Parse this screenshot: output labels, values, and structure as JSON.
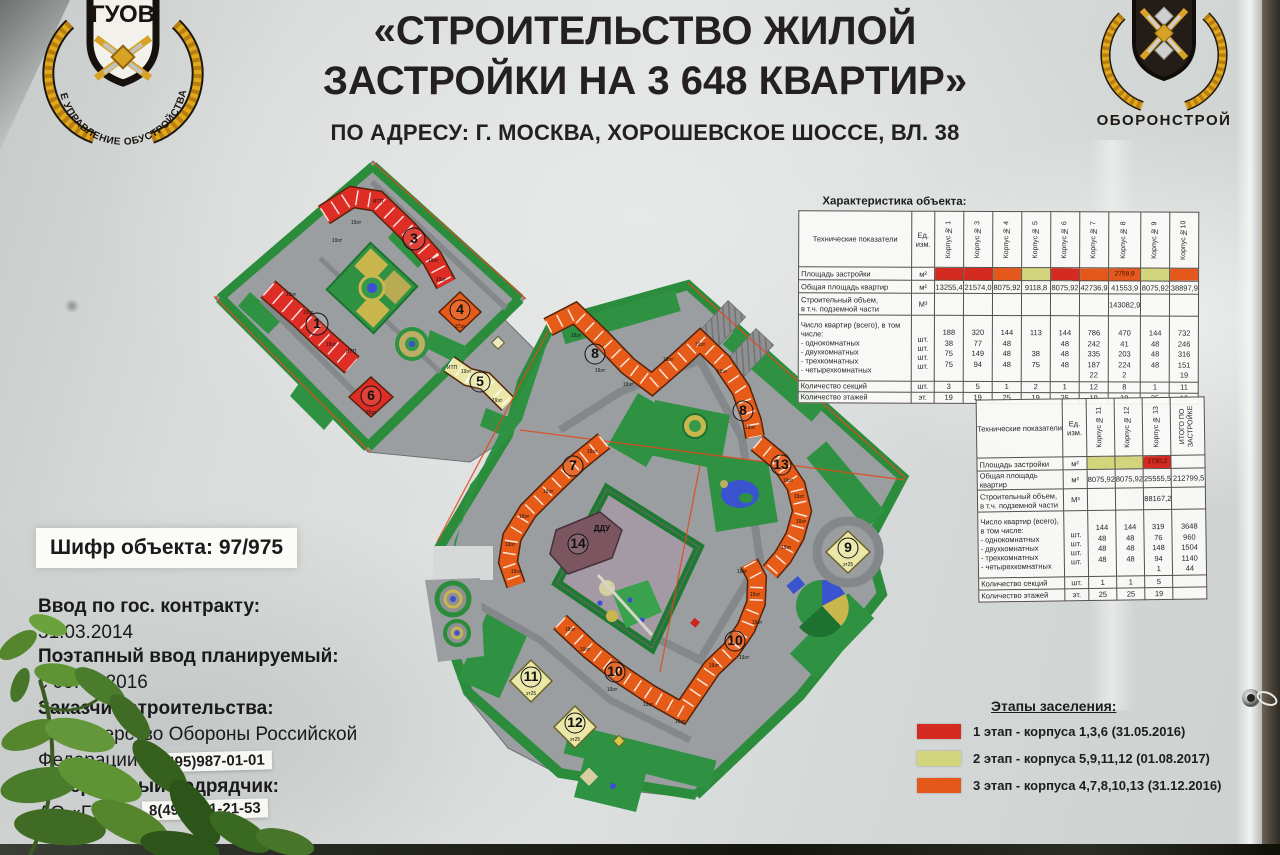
{
  "header": {
    "title_line1": "«СТРОИТЕЛЬСТВО ЖИЛОЙ",
    "title_line2": "ЗАСТРОЙКИ НА 3 648 КВАРТИР»",
    "address": "ПО АДРЕСУ: Г. МОСКВА, ХОРОШЕВСКОЕ ШОССЕ, ВЛ. 38",
    "logo_left": {
      "name": "ГУОВ",
      "ring_text": "ГЛАВНОЕ УПРАВЛЕНИЕ ОБУСТРОЙСТВА ВОЙСК"
    },
    "logo_right": {
      "name": "ОБОРОНСТРОЙ"
    }
  },
  "info": {
    "code_text": "Шифр объекта: 97/975",
    "contract_label": "Ввод по гос. контракту:",
    "contract_date": "31.03.2014",
    "phased_label": "Поэтапный ввод планируемый:",
    "phased_date": "с 09.05.2016",
    "customer_label": "Заказчик строительства:",
    "customer_line1": "Министерство Обороны Российской",
    "customer_line2": "Федерации",
    "customer_phone": "8(495)987-01-01",
    "contractor_label": "Генеральный подрядчик:",
    "contractor_name": "АО «ГУОВ»",
    "contractor_phone": "8(495)781-21-53"
  },
  "stage_colors": {
    "red": "#d42a1f",
    "yellow": "#d2d57b",
    "orange": "#e4581c",
    "none": ""
  },
  "tables": [
    {
      "caption": "Характеристика объекта:",
      "head_label": "Технические показатели",
      "head_unit": "Ед.\nизм.",
      "cols": [
        "Корпус № 1",
        "Корпус № 3",
        "Корпус № 4",
        "Корпус № 5",
        "Корпус № 6",
        "Корпус № 7",
        "Корпус № 8",
        "Корпус № 9",
        "Корпус №10"
      ],
      "rows": [
        {
          "type": "stage",
          "label": "Площадь застройки",
          "unit": "м²",
          "cells": [
            {
              "s": "red"
            },
            {
              "s": "red"
            },
            {
              "s": "orange"
            },
            {
              "s": "yellow"
            },
            {
              "s": "red"
            },
            {
              "s": "orange"
            },
            {
              "s": "orange",
              "v": "2759,9"
            },
            {
              "s": "yellow"
            },
            {
              "s": "orange"
            }
          ]
        },
        {
          "type": "plain",
          "label": "Общая площадь квартир",
          "unit": "м²",
          "cells": [
            "13255,4",
            "21574,0",
            "8075,92",
            "9118,8",
            "8075,92",
            "42736,9",
            "41553,9",
            "8075,92",
            "38897,9"
          ]
        },
        {
          "type": "plain",
          "label": "Строительный объем,\nв т.ч. подземной части",
          "unit": "М³",
          "cells": [
            "",
            "",
            "",
            "",
            "",
            "",
            "143082,9",
            "",
            ""
          ]
        },
        {
          "type": "multi",
          "label": "Число квартир (всего), в том числе:\n- однокомнатных\n- двухкомнатных\n- трехкомнатных\n- четырехкомнатных",
          "unit": "\nшт.\nшт.\nшт.\nшт.",
          "cells": [
            [
              "188",
              "38",
              "75",
              "75",
              ""
            ],
            [
              "320",
              "77",
              "149",
              "94",
              ""
            ],
            [
              "144",
              "48",
              "48",
              "48",
              ""
            ],
            [
              "113",
              "",
              "38",
              "75",
              ""
            ],
            [
              "144",
              "48",
              "48",
              "48",
              ""
            ],
            [
              "786",
              "242",
              "335",
              "187",
              "22"
            ],
            [
              "470",
              "41",
              "203",
              "224",
              "2"
            ],
            [
              "144",
              "48",
              "48",
              "48",
              ""
            ],
            [
              "732",
              "246",
              "316",
              "151",
              "19"
            ]
          ]
        },
        {
          "type": "plain",
          "label": "Количество секций",
          "unit": "шт.",
          "cells": [
            "3",
            "5",
            "1",
            "2",
            "1",
            "12",
            "8",
            "1",
            "11"
          ]
        },
        {
          "type": "plain",
          "label": "Количество этажей",
          "unit": "эт.",
          "cells": [
            "19",
            "19",
            "25",
            "19",
            "25",
            "19",
            "19",
            "25",
            "19"
          ]
        }
      ]
    },
    {
      "caption": "",
      "head_label": "Технические показатели",
      "head_unit": "Ед. изм.",
      "cols": [
        "Корпус № 11",
        "Корпус № 12",
        "Корпус № 13",
        "ИТОГО ПО\nЗАСТРОЙКЕ"
      ],
      "rows": [
        {
          "type": "stage",
          "label": "Площадь застройки",
          "unit": "м²",
          "cells": [
            {
              "s": "yellow"
            },
            {
              "s": "yellow"
            },
            {
              "s": "red",
              "v": "1730,2"
            },
            {
              "s": "none"
            }
          ]
        },
        {
          "type": "plain",
          "label": "Общая площадь квартир",
          "unit": "м²",
          "cells": [
            "8075,92",
            "8075,92",
            "25555,5",
            "212799,5"
          ]
        },
        {
          "type": "plain",
          "label": "Строительный объем,\nв т.ч. подземной части",
          "unit": "М³",
          "cells": [
            "",
            "",
            "88167,2",
            ""
          ]
        },
        {
          "type": "multi",
          "label": "Число квартир (всего), в том числе:\n- однокомнатных\n- двухкомнатных\n- трехкомнатных\n- четырехкомнатных",
          "unit": "\nшт.\nшт.\nшт.\nшт.",
          "cells": [
            [
              "144",
              "48",
              "48",
              "48",
              ""
            ],
            [
              "144",
              "48",
              "48",
              "48",
              ""
            ],
            [
              "319",
              "76",
              "148",
              "94",
              "1"
            ],
            [
              "3648",
              "960",
              "1504",
              "1140",
              "44"
            ]
          ]
        },
        {
          "type": "plain",
          "label": "Количество секций",
          "unit": "шт.",
          "cells": [
            "1",
            "1",
            "5",
            ""
          ]
        },
        {
          "type": "plain",
          "label": "Количество этажей",
          "unit": "эт.",
          "cells": [
            "25",
            "25",
            "19",
            ""
          ]
        }
      ]
    }
  ],
  "legend": {
    "title": "Этапы заселения:",
    "items": [
      {
        "stage": "red",
        "text": "1 этап -  корпуса 1,3,6 (31.05.2016)"
      },
      {
        "stage": "yellow",
        "text": "2 этап  - корпуса 5,9,11,12 (01.08.2017)"
      },
      {
        "stage": "orange",
        "text": "3 этап -  корпуса 4,7,8,10,13 (31.12.2016)"
      }
    ]
  },
  "map": {
    "labels": [
      {
        "t": "3",
        "x": 414,
        "y": 243,
        "r": 11
      },
      {
        "t": "1",
        "x": 317,
        "y": 328,
        "r": 11
      },
      {
        "t": "4",
        "x": 460,
        "y": 314,
        "r": 10
      },
      {
        "t": "5",
        "x": 480,
        "y": 386,
        "r": 10
      },
      {
        "t": "6",
        "x": 371,
        "y": 400,
        "r": 10
      },
      {
        "t": "7",
        "x": 573,
        "y": 470,
        "r": 10
      },
      {
        "t": "8",
        "x": 595,
        "y": 358,
        "r": 10
      },
      {
        "t": "8",
        "x": 743,
        "y": 415,
        "r": 10
      },
      {
        "t": "9",
        "x": 848,
        "y": 552,
        "r": 10
      },
      {
        "t": "10",
        "x": 615,
        "y": 676,
        "r": 10
      },
      {
        "t": "10",
        "x": 735,
        "y": 645,
        "r": 10
      },
      {
        "t": "11",
        "x": 531,
        "y": 681,
        "r": 10
      },
      {
        "t": "12",
        "x": 575,
        "y": 727,
        "r": 10
      },
      {
        "t": "13",
        "x": 781,
        "y": 469,
        "r": 10
      },
      {
        "t": "14",
        "x": 578,
        "y": 548,
        "r": 10
      },
      {
        "t": "ДДУ",
        "x": 602,
        "y": 531,
        "s": 8,
        "b": 1
      },
      {
        "t": "27эт",
        "x": 460,
        "y": 328,
        "s": 5
      },
      {
        "t": "25эт",
        "x": 371,
        "y": 414,
        "s": 5
      },
      {
        "t": "эт25",
        "x": 848,
        "y": 566,
        "s": 5
      },
      {
        "t": "эт25",
        "x": 531,
        "y": 695,
        "s": 5
      },
      {
        "t": "эт25",
        "x": 575,
        "y": 741,
        "s": 5
      },
      {
        "t": "ИТП",
        "x": 378,
        "y": 203,
        "s": 5
      },
      {
        "t": "ИТП",
        "x": 351,
        "y": 353,
        "s": 5
      },
      {
        "t": "ИТП",
        "x": 452,
        "y": 369,
        "s": 5
      },
      {
        "t": "19эт",
        "x": 356,
        "y": 224,
        "s": 5
      },
      {
        "t": "19эт",
        "x": 337,
        "y": 242,
        "s": 5
      },
      {
        "t": "19эт",
        "x": 433,
        "y": 262,
        "s": 5
      },
      {
        "t": "19эт",
        "x": 441,
        "y": 281,
        "s": 5
      },
      {
        "t": "19эт",
        "x": 291,
        "y": 296,
        "s": 5
      },
      {
        "t": "19эт",
        "x": 308,
        "y": 314,
        "s": 5
      },
      {
        "t": "19эт",
        "x": 331,
        "y": 346,
        "s": 5
      },
      {
        "t": "19эт",
        "x": 466,
        "y": 373,
        "s": 5
      },
      {
        "t": "19эт",
        "x": 497,
        "y": 402,
        "s": 5
      },
      {
        "t": "19эт",
        "x": 576,
        "y": 337,
        "s": 5
      },
      {
        "t": "19эт",
        "x": 600,
        "y": 372,
        "s": 5
      },
      {
        "t": "19эт",
        "x": 628,
        "y": 386,
        "s": 5
      },
      {
        "t": "19эт",
        "x": 668,
        "y": 361,
        "s": 5
      },
      {
        "t": "19эт",
        "x": 700,
        "y": 346,
        "s": 5
      },
      {
        "t": "19эт",
        "x": 722,
        "y": 373,
        "s": 5
      },
      {
        "t": "19эт",
        "x": 750,
        "y": 429,
        "s": 5
      },
      {
        "t": "19эт",
        "x": 788,
        "y": 482,
        "s": 5
      },
      {
        "t": "19эт",
        "x": 799,
        "y": 498,
        "s": 5
      },
      {
        "t": "19эт",
        "x": 801,
        "y": 523,
        "s": 5
      },
      {
        "t": "19эт",
        "x": 786,
        "y": 549,
        "s": 5
      },
      {
        "t": "19эт",
        "x": 592,
        "y": 453,
        "s": 5
      },
      {
        "t": "19эт",
        "x": 548,
        "y": 493,
        "s": 5
      },
      {
        "t": "19эт",
        "x": 524,
        "y": 518,
        "s": 5
      },
      {
        "t": "19эт",
        "x": 510,
        "y": 546,
        "s": 5
      },
      {
        "t": "19эт",
        "x": 516,
        "y": 573,
        "s": 5
      },
      {
        "t": "19эт",
        "x": 570,
        "y": 631,
        "s": 5
      },
      {
        "t": "19эт",
        "x": 585,
        "y": 651,
        "s": 5
      },
      {
        "t": "19эт",
        "x": 612,
        "y": 691,
        "s": 5
      },
      {
        "t": "19эт",
        "x": 648,
        "y": 706,
        "s": 5
      },
      {
        "t": "19эт",
        "x": 680,
        "y": 723,
        "s": 5
      },
      {
        "t": "19эт",
        "x": 714,
        "y": 667,
        "s": 5
      },
      {
        "t": "19эт",
        "x": 744,
        "y": 659,
        "s": 5
      },
      {
        "t": "19эт",
        "x": 757,
        "y": 624,
        "s": 5
      },
      {
        "t": "19эт",
        "x": 755,
        "y": 596,
        "s": 5
      },
      {
        "t": "19эт",
        "x": 742,
        "y": 573,
        "s": 5
      }
    ]
  }
}
